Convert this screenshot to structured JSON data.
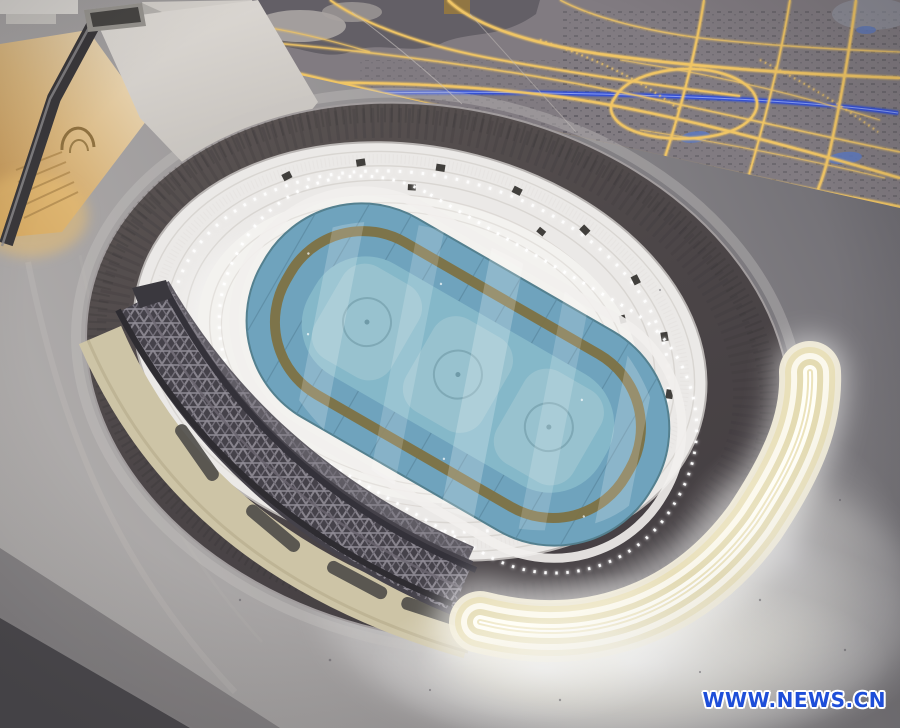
{
  "image": {
    "type": "photograph",
    "description": "Illuminated architectural scale model of an oval speed-skating stadium (blue ice rink, white grandstands, dark roof ring, gray construction truss arc, glowing ribbon facade) on a gray exhibition table, next to a lit city-planning model and a cutaway building model"
  },
  "watermark": {
    "text": "WWW.NEWS.CN",
    "text_color": "#1e4ed8",
    "outline_color": "#ffffff"
  },
  "palette": {
    "table_surface": "#a3a0a1",
    "table_shadow": "#504e52",
    "map_base": "#817b81",
    "map_road_glow": "#f0c565",
    "map_river_blue": "#3050d8",
    "stadium_roof": "#4b4547",
    "stands_white": "#ebe9e7",
    "ice_blue": "#6fa3bd",
    "ice_infield": "#8abccb",
    "track_olive": "#7d7243",
    "truss_gray": "#4a474c",
    "concourse_cream": "#cfc6a8",
    "ribbon_glow": "#f7f3e2",
    "led_white": "#ffffff",
    "building_warm_light": "#d3a868"
  }
}
